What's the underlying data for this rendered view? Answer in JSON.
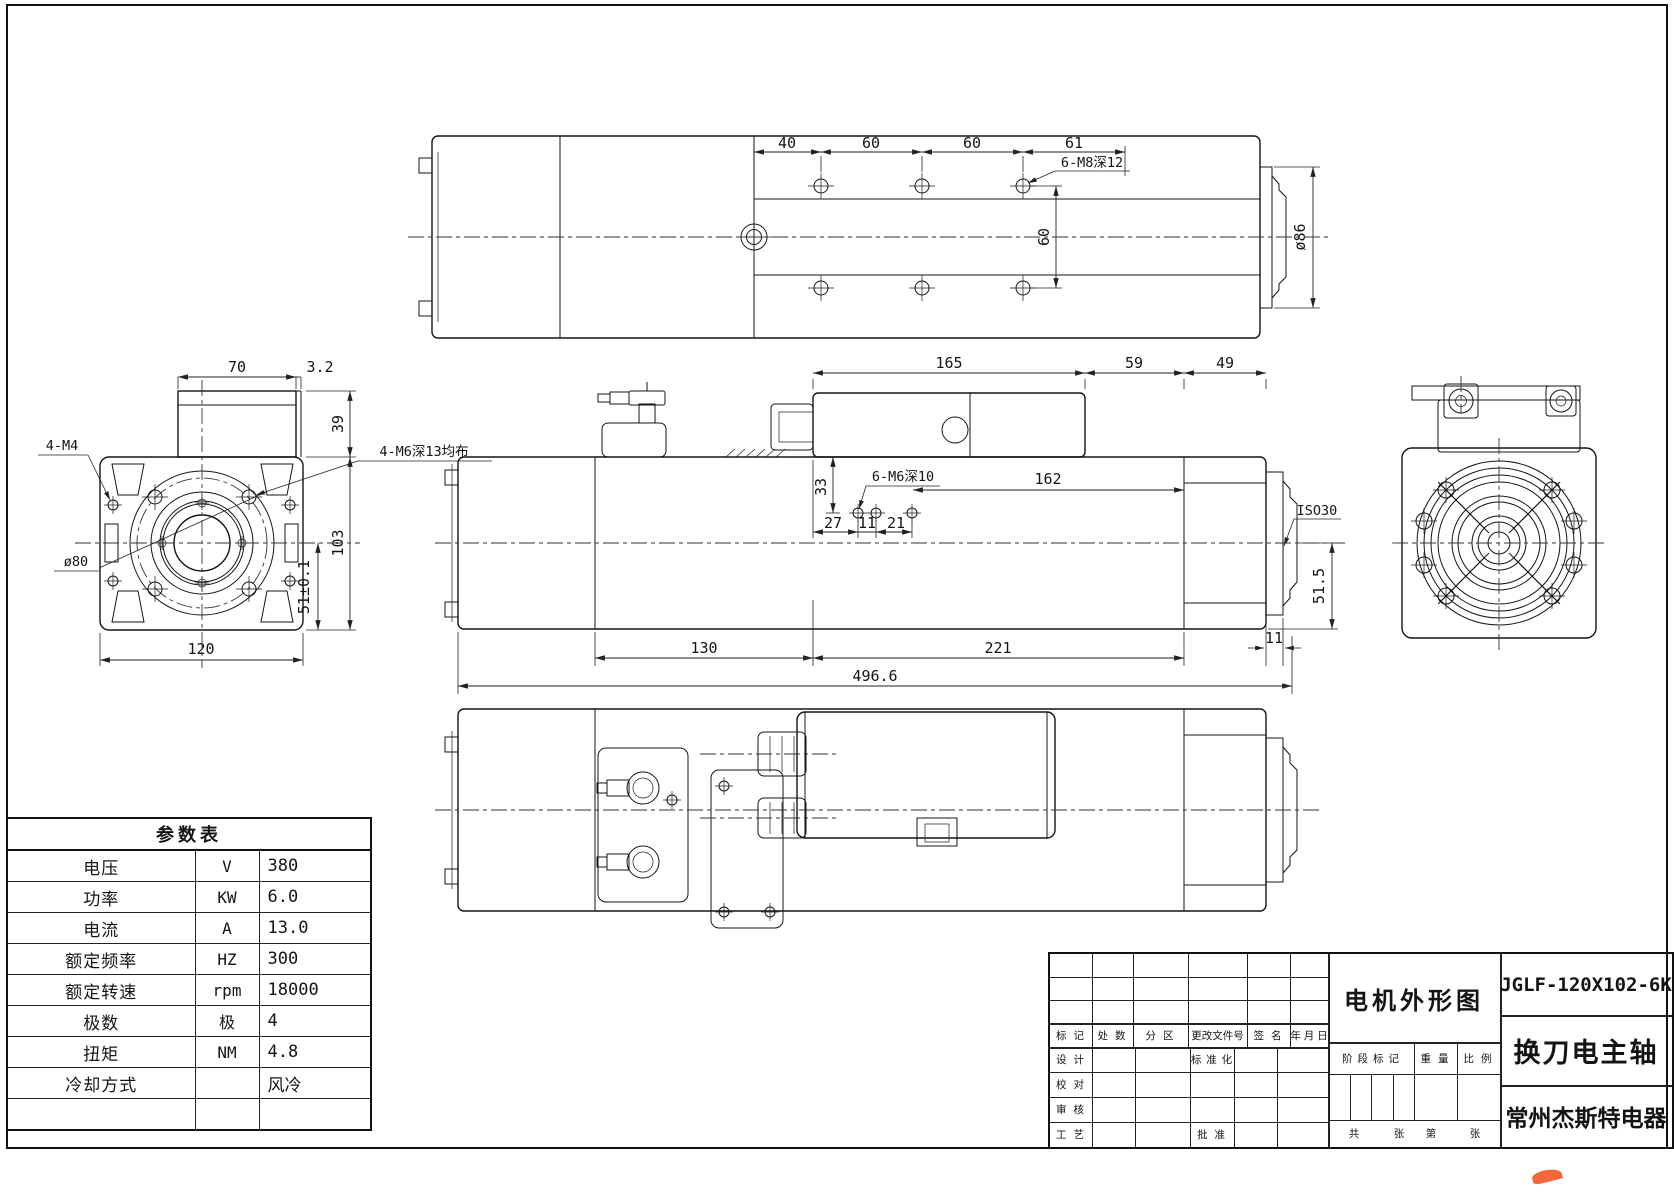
{
  "colors": {
    "ink": "#141414",
    "logo_orange": "#f2683c",
    "background": "#ffffff"
  },
  "top_view": {
    "d40": "40",
    "d60a": "60",
    "d60b": "60",
    "d61": "61",
    "m8_note": "6-M8深12",
    "d60v": "60",
    "dia86": "ø86"
  },
  "front_view": {
    "d70": "70",
    "d3_2": "3.2",
    "d39": "39",
    "d103": "103",
    "d51": "51±0.1",
    "d120": "120",
    "m4_note": "4-M4",
    "dia80": "ø80",
    "m6_note": "4-M6深13均布"
  },
  "side_view": {
    "d165": "165",
    "d59": "59",
    "d49": "49",
    "d33": "33",
    "m6_note": "6-M6深10",
    "d162": "162",
    "d27": "27",
    "d11": "11",
    "d21": "21",
    "iso": "ISO30",
    "d51_5": "51.5",
    "d130": "130",
    "d221": "221",
    "d11b": "11",
    "total": "496.6"
  },
  "param_table": {
    "title": "参数表",
    "rows": [
      {
        "name": "电压",
        "unit": "V",
        "value": "380"
      },
      {
        "name": "功率",
        "unit": "KW",
        "value": "6.0"
      },
      {
        "name": "电流",
        "unit": "A",
        "value": "13.0"
      },
      {
        "name": "额定频率",
        "unit": "HZ",
        "value": "300"
      },
      {
        "name": "额定转速",
        "unit": "rpm",
        "value": "18000"
      },
      {
        "name": "极数",
        "unit": "极",
        "value": "4"
      },
      {
        "name": "扭矩",
        "unit": "NM",
        "value": "4.8"
      },
      {
        "name": "冷却方式",
        "unit": "",
        "value": "风冷"
      },
      {
        "name": "",
        "unit": "",
        "value": ""
      }
    ]
  },
  "title_block": {
    "drawing_title": "电机外形图",
    "model_no": "JGLF-120X102-6K",
    "product_name": "换刀电主轴",
    "company": "常州杰斯特电器",
    "rev_cols": {
      "mark": "标 记",
      "count": "处 数",
      "zone": "分  区",
      "doc": "更改文件号",
      "sign": "签 名",
      "date": "年 月 日"
    },
    "roles": {
      "design": "设 计",
      "proof": "校 对",
      "audit": "审 核",
      "craft": "工 艺",
      "standard": "标 准 化",
      "approve": "批 准"
    },
    "stage": {
      "mark": "阶 段 标 记",
      "weight": "重 量",
      "scale": "比 例"
    },
    "sheets": {
      "total_label": "共",
      "sheet_label": "张",
      "no_label": "第",
      "sheet_label2": "张"
    }
  }
}
